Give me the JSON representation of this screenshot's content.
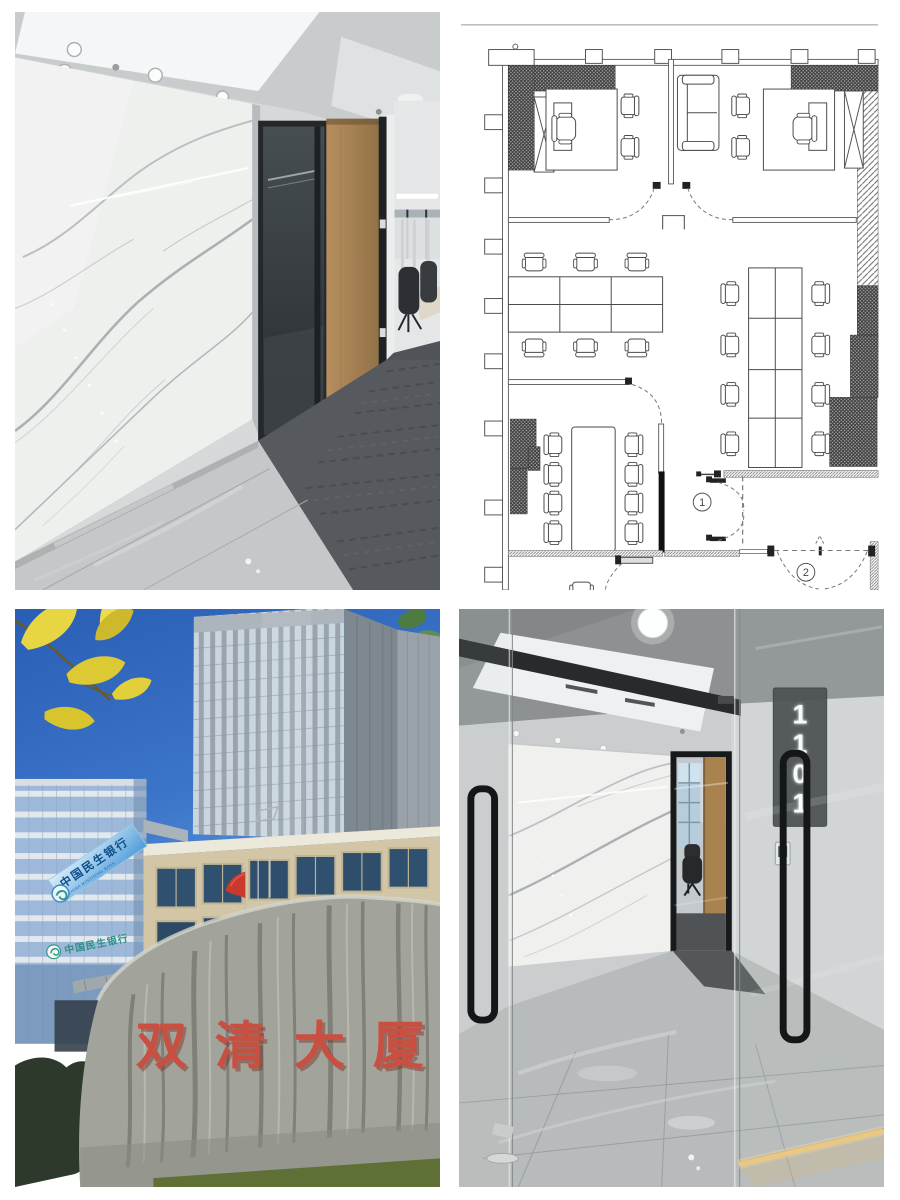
{
  "page": {
    "background": "#ffffff",
    "layout": "2x2 photo collage"
  },
  "tiles": {
    "office_interior": {
      "description": "office interior with white marble feature wall, black framed glass partition, wood door and grey carpet"
    },
    "floor_plan": {
      "description": "black and white CAD office floor plan with two private offices, open desks, meeting room",
      "door_marker_1": "1",
      "door_marker_2": "2"
    },
    "building_exterior": {
      "description": "Shuangqing Building exterior with blue sky, yellow leaves and inscribed landmark rock",
      "rooftop_sign_cn": "中国民生银行",
      "rooftop_sign_en": "CHINA MINSHENG BANK",
      "storefront_sign_cn": "中国民生银行",
      "rock_inscription": "双清大厦"
    },
    "entrance_lobby": {
      "description": "suite glass entrance lobby with marble wall and illuminated unit number",
      "suite_number": "1101",
      "suite_digits": [
        "1",
        "1",
        "0",
        "1"
      ]
    }
  },
  "colors": {
    "sky": "#2f63b8",
    "marble": "#eef0ee",
    "carpet": "#56595d",
    "wood_door": "#ad8a61",
    "rock_inscription_red": "#c94f41",
    "bank_sign_blue": "#4e9bd8",
    "leaf_yellow": "#e8d542",
    "led_warm": "#edc87c"
  }
}
